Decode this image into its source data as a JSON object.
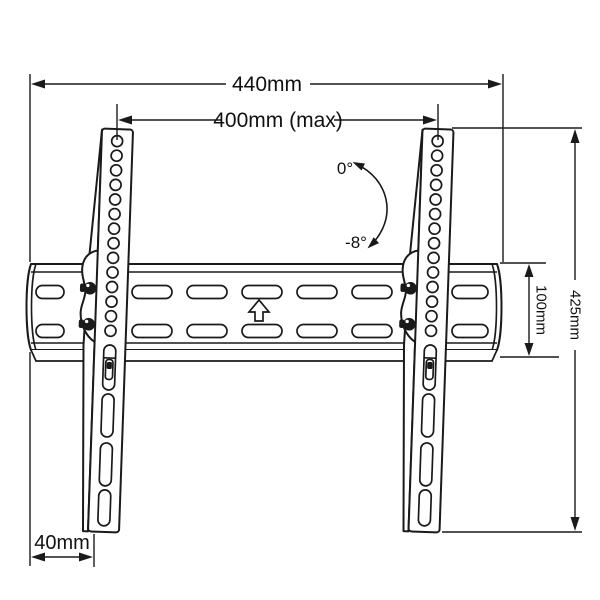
{
  "diagram": {
    "subject": "Tilting TV wall-mount bracket, front view technical drawing",
    "colors": {
      "line": "#1a1a1a",
      "background": "#ffffff"
    },
    "dimensions": {
      "overall_width": "440mm",
      "max_mounting_width": "400mm (max)",
      "overall_height": "425mm",
      "wall_plate_height": "100mm",
      "side_offset": "40mm"
    },
    "tilt": {
      "upper": "0°",
      "lower": "-8°"
    }
  }
}
